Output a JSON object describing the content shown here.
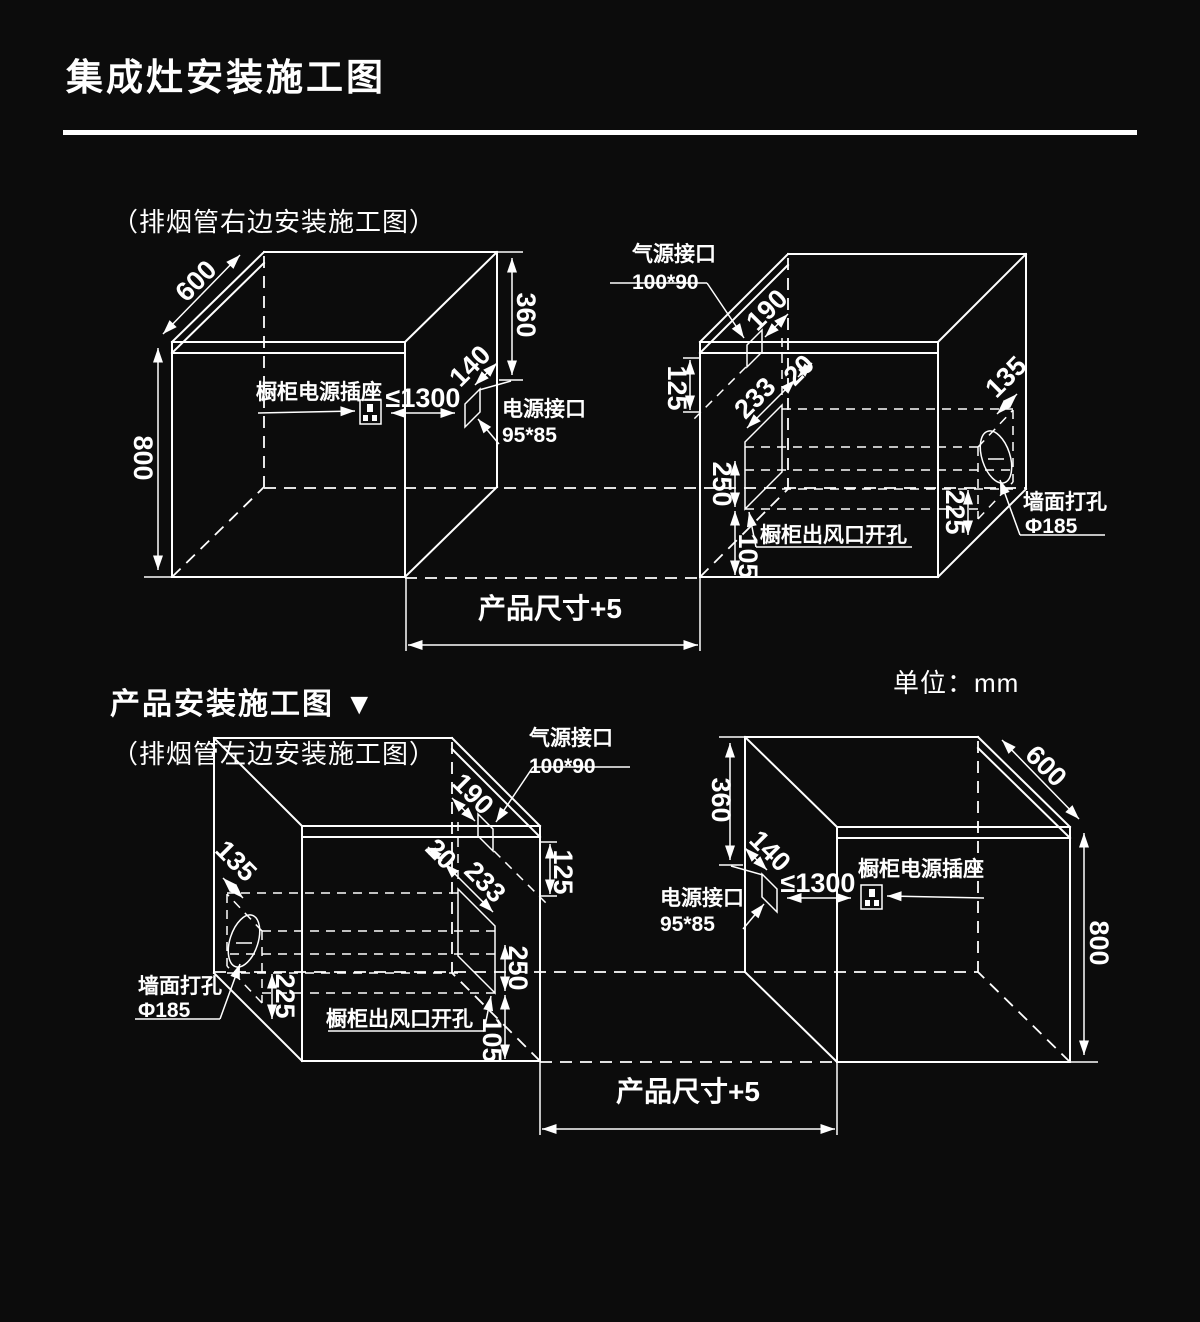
{
  "page": {
    "background": "#0c0c0c",
    "line_color": "#ffffff"
  },
  "header": {
    "title": "集成灶安装施工图"
  },
  "sections": {
    "top_caption": "（排烟管右边安装施工图）",
    "product_heading": "产品安装施工图 ▼",
    "bottom_caption": "（排烟管左边安装施工图）",
    "unit_label": "单位：mm"
  },
  "labels": {
    "cabinet_socket": "橱柜电源插座",
    "power_interface": "电源接口",
    "power_interface_size": "95*85",
    "gas_interface": "气源接口",
    "gas_interface_size": "100*90",
    "vent_opening": "橱柜出风口开孔",
    "wall_hole": "墙面打孔",
    "wall_hole_size": "Φ185",
    "product_size": "产品尺寸+5",
    "max_socket_distance": "≤1300"
  },
  "dimensions": {
    "cabinet_depth": "600",
    "cabinet_height": "800",
    "top_height": "360",
    "power_offset": "140",
    "gas_depth": "190",
    "gas_drop": "125",
    "vent_gap": "20",
    "vent_width": "233",
    "vent_height": "250",
    "vent_bottom_gap": "105",
    "hole_height": "225",
    "hole_offset": "135"
  }
}
